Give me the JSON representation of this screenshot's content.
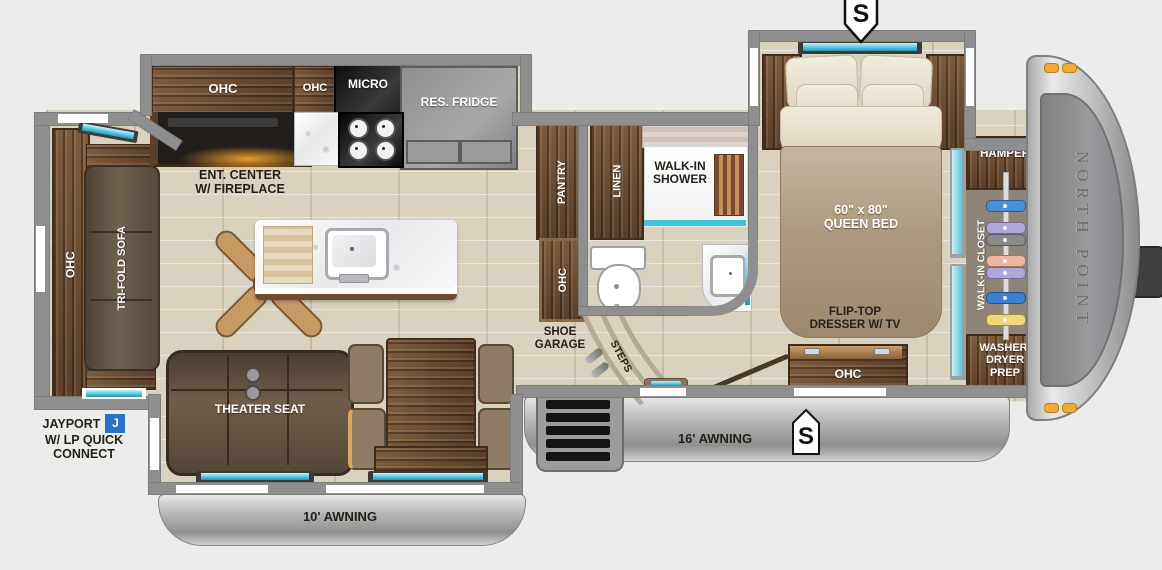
{
  "colors": {
    "accent_teal": "#3fb9d6",
    "badge_blue": "#2a72c8",
    "marker_orange": "#f2a93b",
    "wall_gray": "#8f8f8f",
    "floor_beige": "#d9d2bf"
  },
  "exterior": {
    "spot_top": "S",
    "spot_bottom": "S",
    "awning_left": "10' AWNING",
    "awning_right": "16' AWNING",
    "brand": "NORTH POINT",
    "jayport_line1": "JAYPORT",
    "jayport_badge": "J",
    "jayport_line2": "W/ LP QUICK",
    "jayport_line3": "CONNECT"
  },
  "kitchen": {
    "ohc_left": "OHC",
    "ohc_right": "OHC",
    "micro": "MICRO",
    "fridge": "RES. FRIDGE",
    "ent_line1": "ENT. CENTER",
    "ent_line2": "W/ FIREPLACE"
  },
  "rear": {
    "ohc": "OHC",
    "sofa": "TRI-FOLD SOFA"
  },
  "living": {
    "theater": "THEATER SEAT"
  },
  "bath": {
    "pantry": "PANTRY",
    "pantry_ohc": "OHC",
    "linen": "LINEN",
    "shower_line1": "WALK-IN",
    "shower_line2": "SHOWER"
  },
  "hall": {
    "shoe_line1": "SHOE",
    "shoe_line2": "GARAGE",
    "steps": "STEPS"
  },
  "bedroom": {
    "bed_size": "60\" x 80\"",
    "bed_name": "QUEEN BED",
    "dresser_line1": "FLIP-TOP",
    "dresser_line2": "DRESSER W/ TV",
    "dresser_ohc": "OHC"
  },
  "closet": {
    "hamper": "HAMPER",
    "walkin": "WALK-IN CLOSET",
    "washer_line1": "WASHER/",
    "washer_line2": "DRYER",
    "washer_line3": "PREP"
  }
}
